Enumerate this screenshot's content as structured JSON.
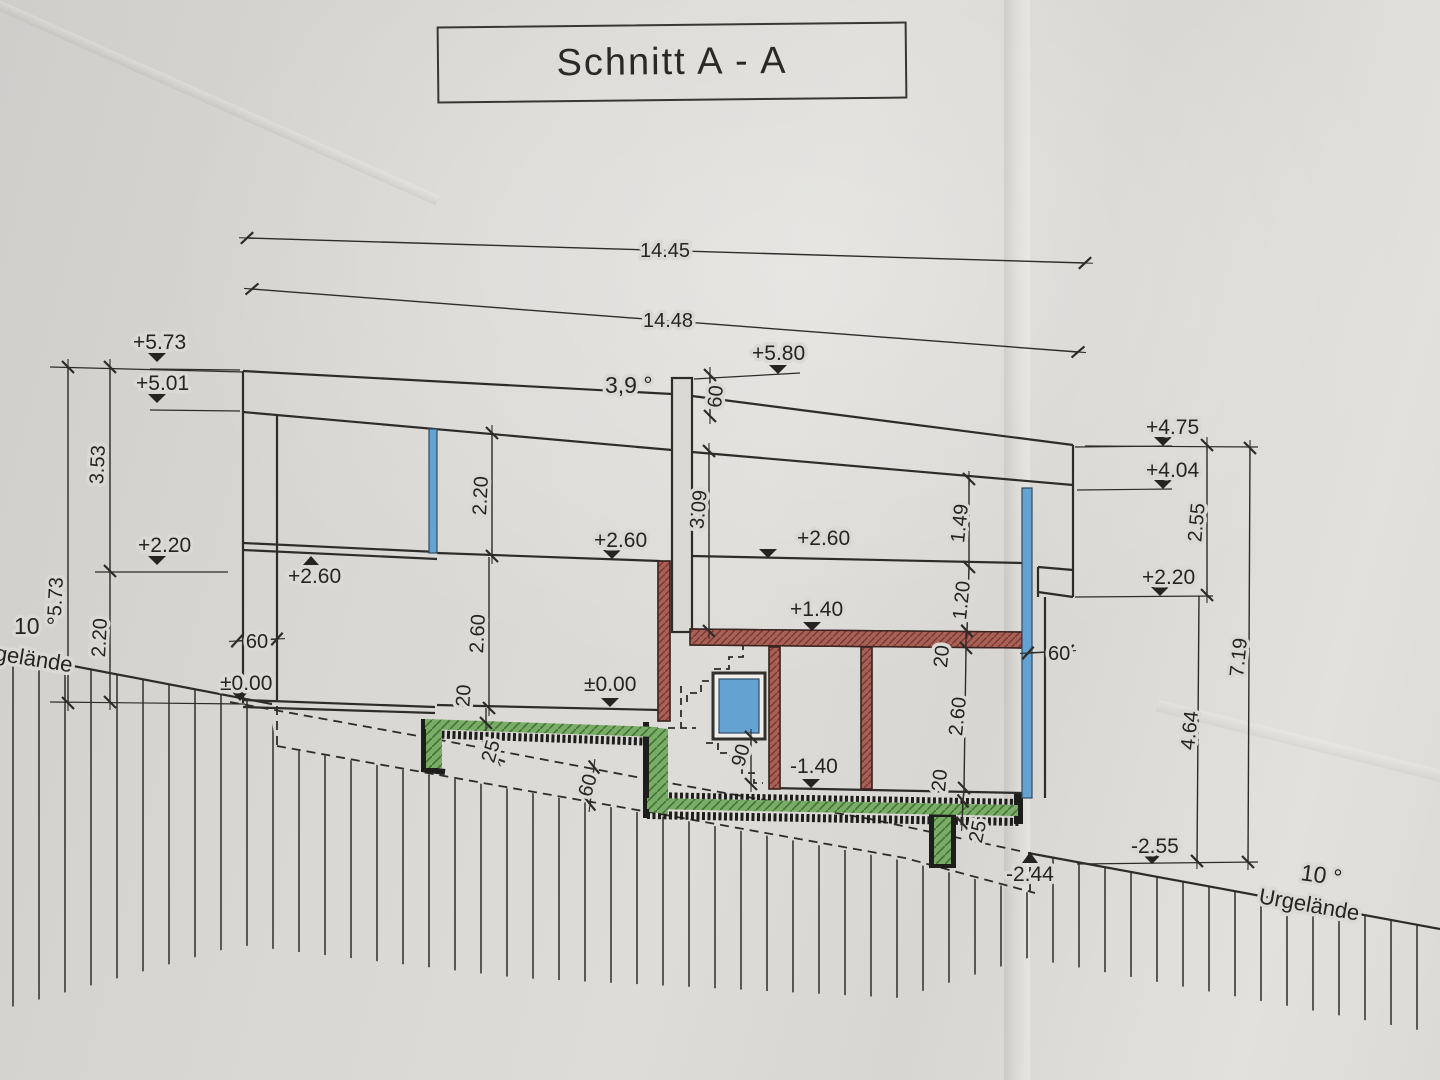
{
  "title": "Schnitt A - A",
  "drawing_type": "building cross-section",
  "colors": {
    "paper": "#dbd9d5",
    "line": "#2e2c29",
    "slab_green": "#79ad66",
    "wall_red": "#a86157",
    "glass_blue": "#64a3d1",
    "insulation_black": "#1d1d1b"
  },
  "annotations": {
    "overall_top": "14.45",
    "overall_ground": "14.48",
    "left": {
      "lv_top": "+5.73",
      "lv_roof": "+5.01",
      "lv_parapet": "+2.20",
      "lv_ceiling": "+2.60",
      "lv_zero": "±0.00",
      "h_total": "5.73",
      "h_upper": "3.53",
      "h_lower": "2.20",
      "wall_width": "60",
      "slope": "10 °",
      "ground_label": "gelände"
    },
    "center": {
      "roof_slope": "3,9 °",
      "lv_chimney_top": "+5.80",
      "chimney_height": "60",
      "h_roof_to_slab": "3.09",
      "h_room_upper": "2.20",
      "lv_ceiling": "+2.60",
      "h_room_main": "2.60",
      "slab_thickness": "20",
      "lv_zero": "±0.00",
      "slab_edge": "25",
      "excavation_offset": "60",
      "door_height": "90",
      "lv_basement": "-1.40",
      "lv_mid_slab": "+1.40",
      "lv_ceiling_right": "+2.60"
    },
    "right": {
      "lv_parapet": "+4.75",
      "lv_roof": "+4.04",
      "lv_wall_top": "+2.20",
      "h_parapet": "2.55",
      "h_wall_lower": "4.64",
      "h_total": "7.19",
      "h_roof_edge": "1.49",
      "h_upper": "1.20",
      "slab_20_top": "20",
      "h_room": "2.60",
      "slab_20_floor": "20",
      "slab_edge": "25",
      "wall_width": "60",
      "lv_foundation": "-2.44",
      "lv_ground": "-2.55",
      "slope": "10 °",
      "ground_label": "Urgelände"
    }
  }
}
